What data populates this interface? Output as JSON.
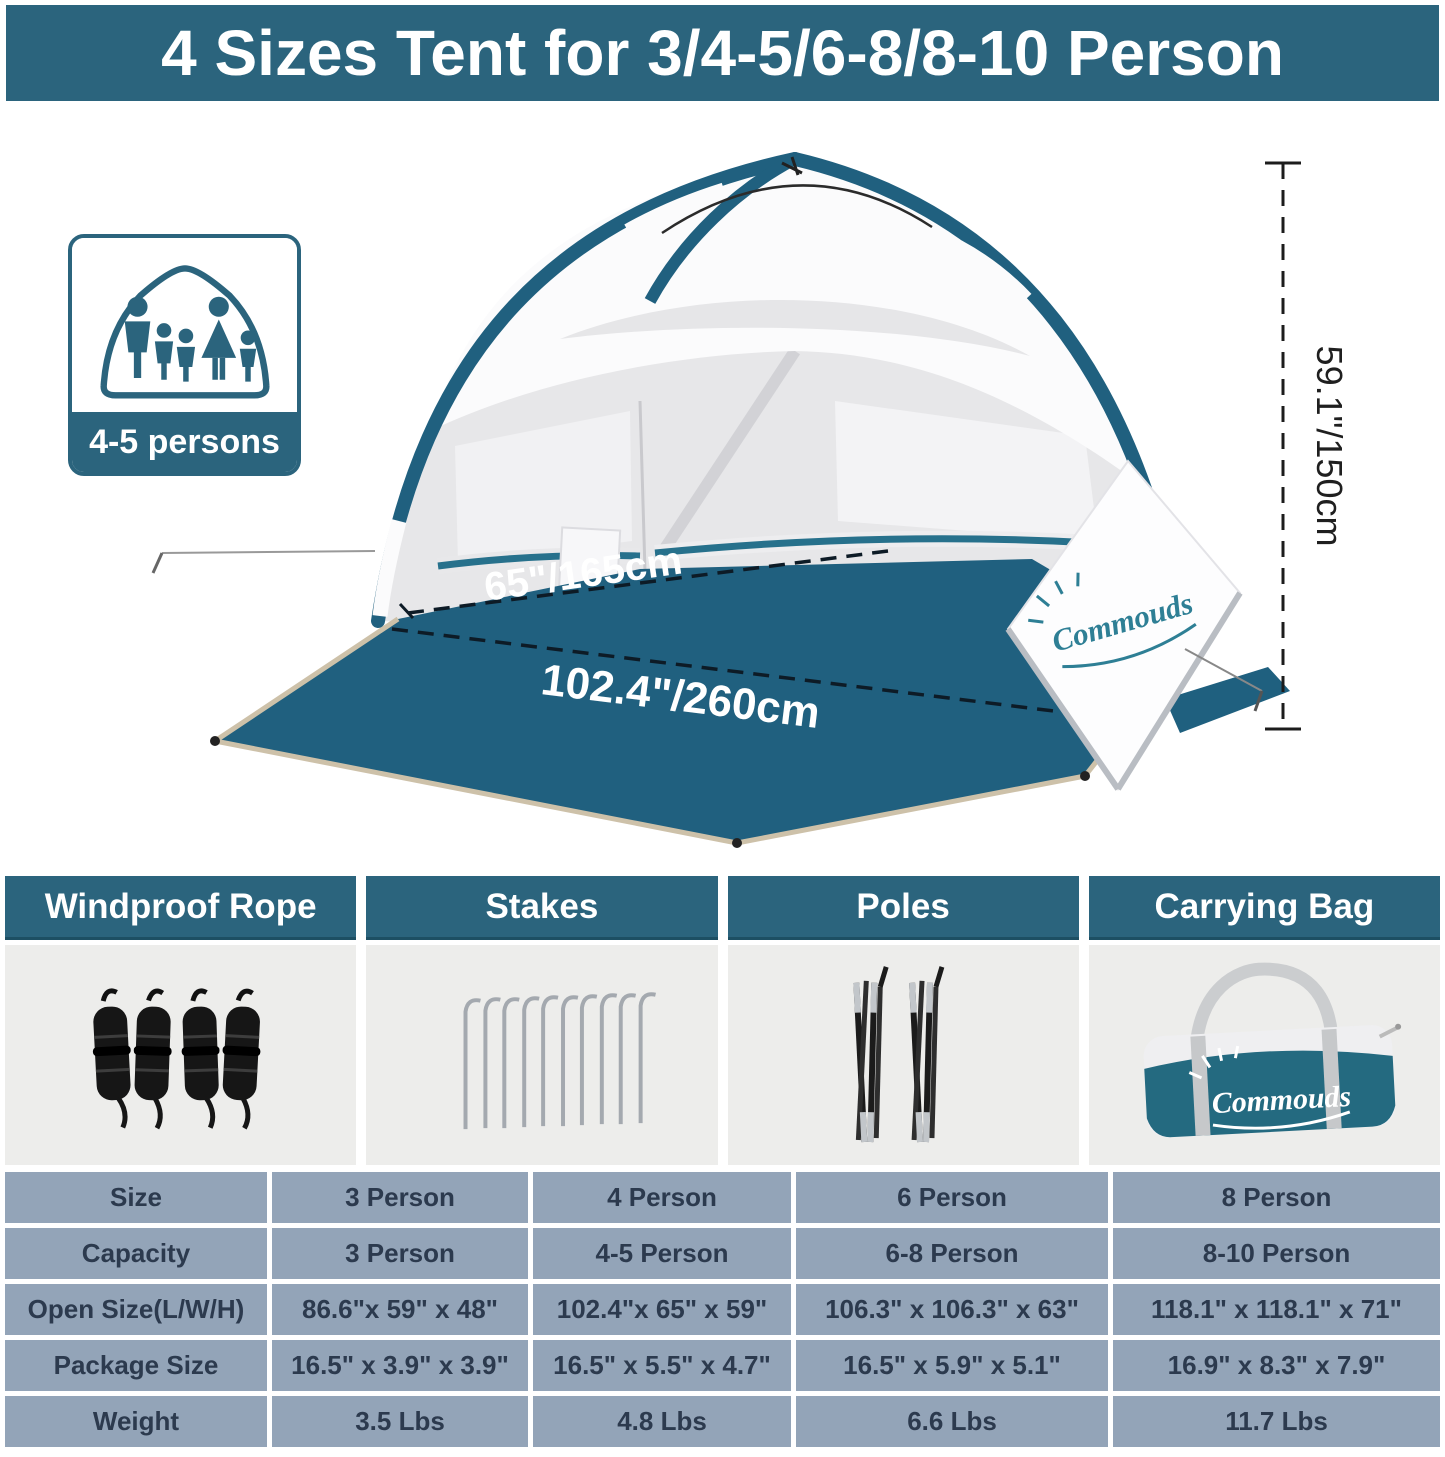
{
  "banner": {
    "title": "4 Sizes Tent for 3/4-5/6-8/8-10 Person"
  },
  "brand": {
    "name": "Commouds"
  },
  "hero": {
    "capacity_badge": {
      "label": "4-5 persons"
    },
    "dimensions": {
      "width": "65\"/165cm",
      "length": "102.4\"/260cm",
      "height": "59.1\"/150cm"
    }
  },
  "accessories": [
    {
      "label": "Windproof Rope"
    },
    {
      "label": "Stakes"
    },
    {
      "label": "Poles"
    },
    {
      "label": "Carrying Bag"
    }
  ],
  "spec_table": {
    "rows": [
      {
        "label": "Size",
        "values": [
          "3 Person",
          "4 Person",
          "6 Person",
          "8 Person"
        ]
      },
      {
        "label": "Capacity",
        "values": [
          "3 Person",
          "4-5 Person",
          "6-8 Person",
          "8-10 Person"
        ]
      },
      {
        "label": "Open Size(L/W/H)",
        "values": [
          "86.6\"x 59\" x 48\"",
          "102.4\"x 65\" x 59\"",
          "106.3\" x 106.3\" x 63\"",
          "118.1\" x 118.1\" x 71\""
        ]
      },
      {
        "label": "Package Size",
        "values": [
          "16.5\" x 3.9\" x 3.9\"",
          "16.5\" x 5.5\" x 4.7\"",
          "16.5\" x 5.9\" x 5.1\"",
          "16.9\" x 8.3\" x 7.9\""
        ]
      },
      {
        "label": "Weight",
        "values": [
          "3.5 Lbs",
          "4.8 Lbs",
          "6.6 Lbs",
          "11.7 Lbs"
        ]
      }
    ]
  },
  "colors": {
    "teal": "#2b647d",
    "floor_teal": "#20607f",
    "table_cell": "#93a4b8",
    "panel_gray": "#ededeb"
  }
}
